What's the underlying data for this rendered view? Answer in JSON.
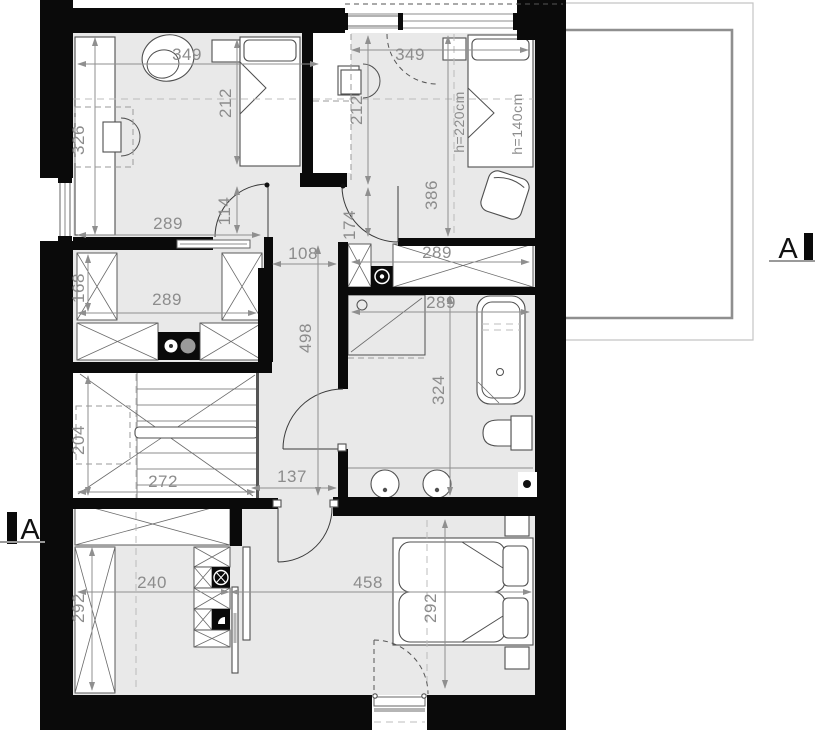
{
  "plan": {
    "title_hint": "attic floor plan",
    "colors": {
      "wall": "#0a0a0a",
      "floor": "#e9e9e9",
      "dimension_text": "#8c8c8c",
      "furniture_line": "#4f4f4f",
      "dashed_line": "#9a9a9a",
      "terrace_outline": "#8f8f8f"
    },
    "section_markers": {
      "left": "A",
      "right": "A"
    },
    "labels": [
      {
        "text": "349",
        "x": 187,
        "y": 60,
        "rot": 0
      },
      {
        "text": "326",
        "x": 84,
        "y": 140,
        "rot": -90
      },
      {
        "text": "212",
        "x": 231,
        "y": 103,
        "rot": -90
      },
      {
        "text": "289",
        "x": 168,
        "y": 229,
        "rot": 0
      },
      {
        "text": "114",
        "x": 230,
        "y": 211,
        "rot": -90
      },
      {
        "text": "349",
        "x": 410,
        "y": 60,
        "rot": 0
      },
      {
        "text": "212",
        "x": 362,
        "y": 110,
        "rot": -90
      },
      {
        "text": "174",
        "x": 355,
        "y": 225,
        "rot": -90
      },
      {
        "text": "386",
        "x": 437,
        "y": 195,
        "rot": -90
      },
      {
        "text": "h=220cm",
        "x": 464,
        "y": 122,
        "rot": -90,
        "size": "small"
      },
      {
        "text": "h=140cm",
        "x": 522,
        "y": 124,
        "rot": -90,
        "size": "small"
      },
      {
        "text": "168",
        "x": 84,
        "y": 288,
        "rot": -90
      },
      {
        "text": "289",
        "x": 167,
        "y": 305,
        "rot": 0
      },
      {
        "text": "108",
        "x": 303,
        "y": 259,
        "rot": 0
      },
      {
        "text": "498",
        "x": 311,
        "y": 338,
        "rot": -90
      },
      {
        "text": "289",
        "x": 437,
        "y": 258,
        "rot": 0
      },
      {
        "text": "289",
        "x": 441,
        "y": 308,
        "rot": 0
      },
      {
        "text": "324",
        "x": 444,
        "y": 390,
        "rot": -90
      },
      {
        "text": "204",
        "x": 84,
        "y": 440,
        "rot": -90
      },
      {
        "text": "272",
        "x": 163,
        "y": 487,
        "rot": 0
      },
      {
        "text": "137",
        "x": 292,
        "y": 482,
        "rot": 0
      },
      {
        "text": "240",
        "x": 152,
        "y": 588,
        "rot": 0
      },
      {
        "text": "292",
        "x": 84,
        "y": 608,
        "rot": -90
      },
      {
        "text": "458",
        "x": 368,
        "y": 588,
        "rot": 0
      },
      {
        "text": "292",
        "x": 436,
        "y": 608,
        "rot": -90
      }
    ]
  }
}
